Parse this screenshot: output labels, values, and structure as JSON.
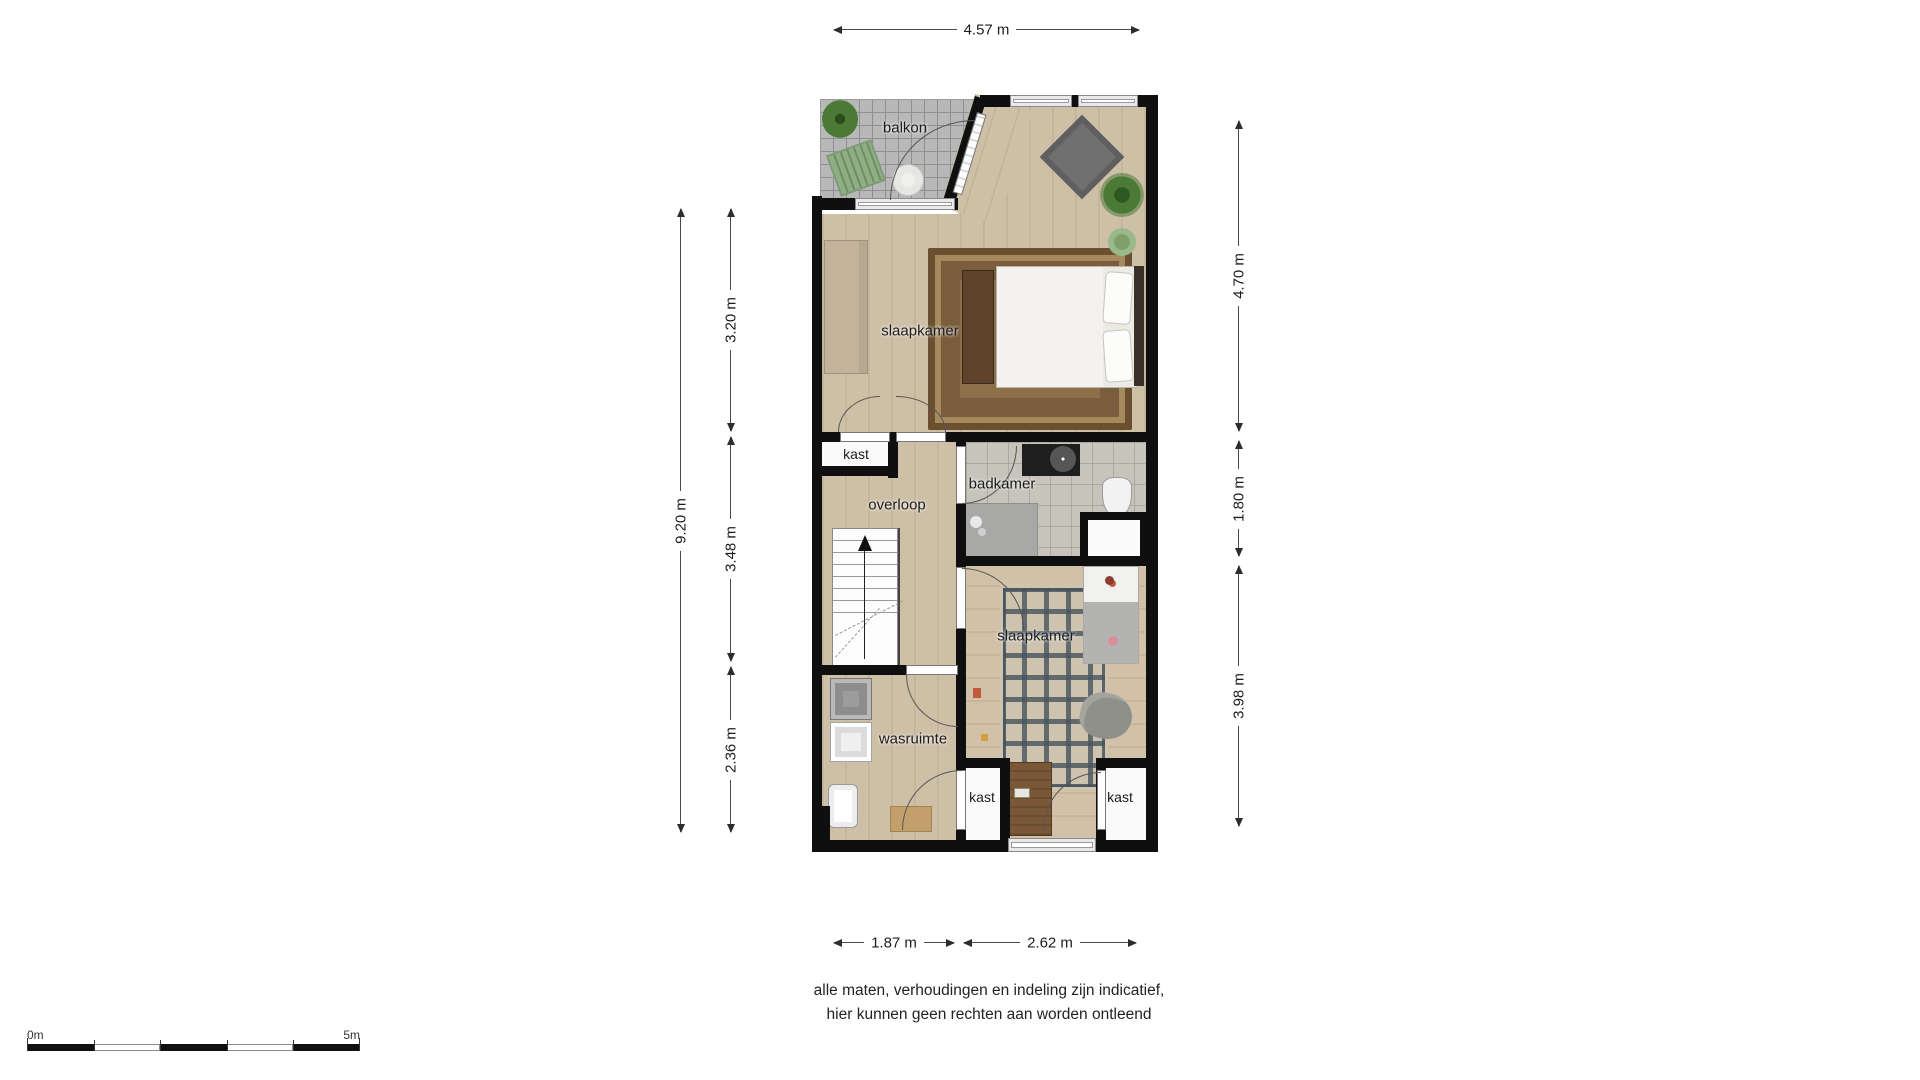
{
  "plan_type": "floor-plan",
  "rooms": {
    "balkon": {
      "label": "balkon"
    },
    "slaapkamer_top": {
      "label": "slaapkamer"
    },
    "kast_top": {
      "label": "kast"
    },
    "overloop": {
      "label": "overloop"
    },
    "badkamer": {
      "label": "badkamer"
    },
    "slaapkamer_bottom": {
      "label": "slaapkamer"
    },
    "wasruimte": {
      "label": "wasruimte"
    },
    "kast_bottom_left": {
      "label": "kast"
    },
    "kast_bottom_right": {
      "label": "kast"
    }
  },
  "dimensions": {
    "top_width": "4.57 m",
    "left_total_height": "9.20 m",
    "left_segment_top": "3.20 m",
    "left_segment_middle": "3.48 m",
    "left_segment_bottom": "2.36 m",
    "right_segment_top": "4.70 m",
    "right_segment_middle": "1.80 m",
    "right_segment_bottom": "3.98 m",
    "bottom_segment_left": "1.87 m",
    "bottom_segment_right": "2.62 m"
  },
  "scale_bar": {
    "start_label": "0m",
    "end_label": "5m"
  },
  "disclaimer": {
    "line1": "alle maten, verhoudingen en indeling zijn indicatief,",
    "line2": "hier kunnen geen rechten aan worden ontleend"
  },
  "colors": {
    "wall": "#0f0f0f",
    "wood_floor": "#cec0a7",
    "balcony_tile": "#b8b8b8",
    "bathroom_tile": "#c7c4bc",
    "main_rug": "#8d6f4a",
    "gray_accent_rug": "#707070",
    "kids_rug_pattern": "#48545e",
    "plant_green": "#4a7a36",
    "dimension_line": "#4a4a4a"
  }
}
